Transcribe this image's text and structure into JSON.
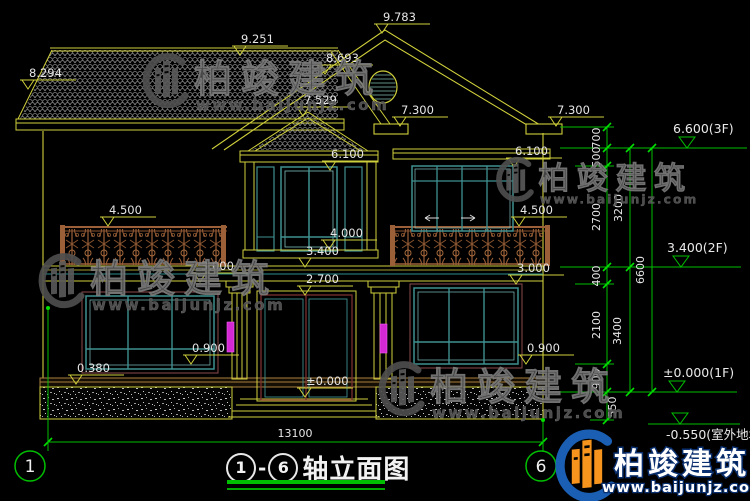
{
  "colors": {
    "line_yellow": "#cfcf3c",
    "dim_green": "#00bf00",
    "text_white": "#e6e6e6",
    "window_teal": "#3f9090",
    "window_teal_light": "#7fc0c0",
    "railing_brown": "#9c6038",
    "lamp_magenta": "#d428d4",
    "door_maroon": "#7a3030",
    "base_tan": "#a8803c",
    "watermark_gray": "#555555",
    "logo_blue": "#1a5fb4",
    "logo_orange": "#f7941d"
  },
  "elevation_markers": [
    {
      "label": "9.783",
      "x": 382,
      "y": 33
    },
    {
      "label": "9.251",
      "x": 240,
      "y": 55
    },
    {
      "label": "8.693",
      "x": 325,
      "y": 74
    },
    {
      "label": "8.294",
      "x": 28,
      "y": 89
    },
    {
      "label": "7.529",
      "x": 303,
      "y": 116
    },
    {
      "label": "7.300",
      "x": 400,
      "y": 126
    },
    {
      "label": "7.300",
      "x": 556,
      "y": 126
    },
    {
      "label": "6.100",
      "x": 330,
      "y": 170
    },
    {
      "label": "6.100",
      "x": 514,
      "y": 167
    },
    {
      "label": "4.500",
      "x": 108,
      "y": 226
    },
    {
      "label": "4.500",
      "x": 519,
      "y": 226
    },
    {
      "label": "4.000",
      "x": 329,
      "y": 249
    },
    {
      "label": "3.400",
      "x": 305,
      "y": 267
    },
    {
      "label": "3.000",
      "x": 200,
      "y": 282
    },
    {
      "label": "3.000",
      "x": 516,
      "y": 284
    },
    {
      "label": "2.700",
      "x": 305,
      "y": 295
    },
    {
      "label": "0.900",
      "x": 191,
      "y": 364
    },
    {
      "label": "0.900",
      "x": 526,
      "y": 364
    },
    {
      "label": "0.380",
      "x": 76,
      "y": 384
    },
    {
      "label": "±0.000",
      "x": 305,
      "y": 397
    }
  ],
  "floor_markers": [
    {
      "label": "6.600(3F)",
      "x": 687,
      "y": 148,
      "below": false
    },
    {
      "label": "3.400(2F)",
      "x": 681,
      "y": 267,
      "below": false
    },
    {
      "label": "±0.000(1F)",
      "x": 677,
      "y": 392,
      "below": false
    },
    {
      "label": "-0.550(室外地坪)",
      "x": 680,
      "y": 424,
      "below": true
    }
  ],
  "dim_chain": {
    "labels": [
      {
        "text": "700",
        "x": 600,
        "y": 138
      },
      {
        "text": "500",
        "x": 600,
        "y": 157
      },
      {
        "text": "2700",
        "x": 600,
        "y": 217
      },
      {
        "text": "400",
        "x": 600,
        "y": 276
      },
      {
        "text": "2100",
        "x": 600,
        "y": 325
      },
      {
        "text": "900",
        "x": 600,
        "y": 379
      },
      {
        "text": "550",
        "x": 616,
        "y": 407
      },
      {
        "text": "3200",
        "x": 622,
        "y": 208
      },
      {
        "text": "3400",
        "x": 621,
        "y": 331
      },
      {
        "text": "6600",
        "x": 644,
        "y": 270
      }
    ]
  },
  "bottom_dim": {
    "text": "13100"
  },
  "axes": [
    {
      "label": "1",
      "cx": 30,
      "cy": 466,
      "lx": 48,
      "ly": 308
    },
    {
      "label": "6",
      "cx": 541,
      "cy": 466,
      "lx": 543,
      "ly": 420
    }
  ],
  "title": {
    "axis_from": "1",
    "separator": "-",
    "axis_to": "6",
    "label": "轴立面图"
  },
  "watermarks": {
    "text": "柏竣建筑",
    "url": "www.baijunjz.com",
    "instances": [
      {
        "x": 140,
        "y": 52,
        "s": 1.0
      },
      {
        "x": 494,
        "y": 156,
        "s": 0.82
      },
      {
        "x": 36,
        "y": 252,
        "s": 1.0
      },
      {
        "x": 376,
        "y": 360,
        "s": 1.0
      }
    ]
  },
  "logo": {
    "text": "柏竣建筑",
    "url": "www.baijunjz.com"
  }
}
